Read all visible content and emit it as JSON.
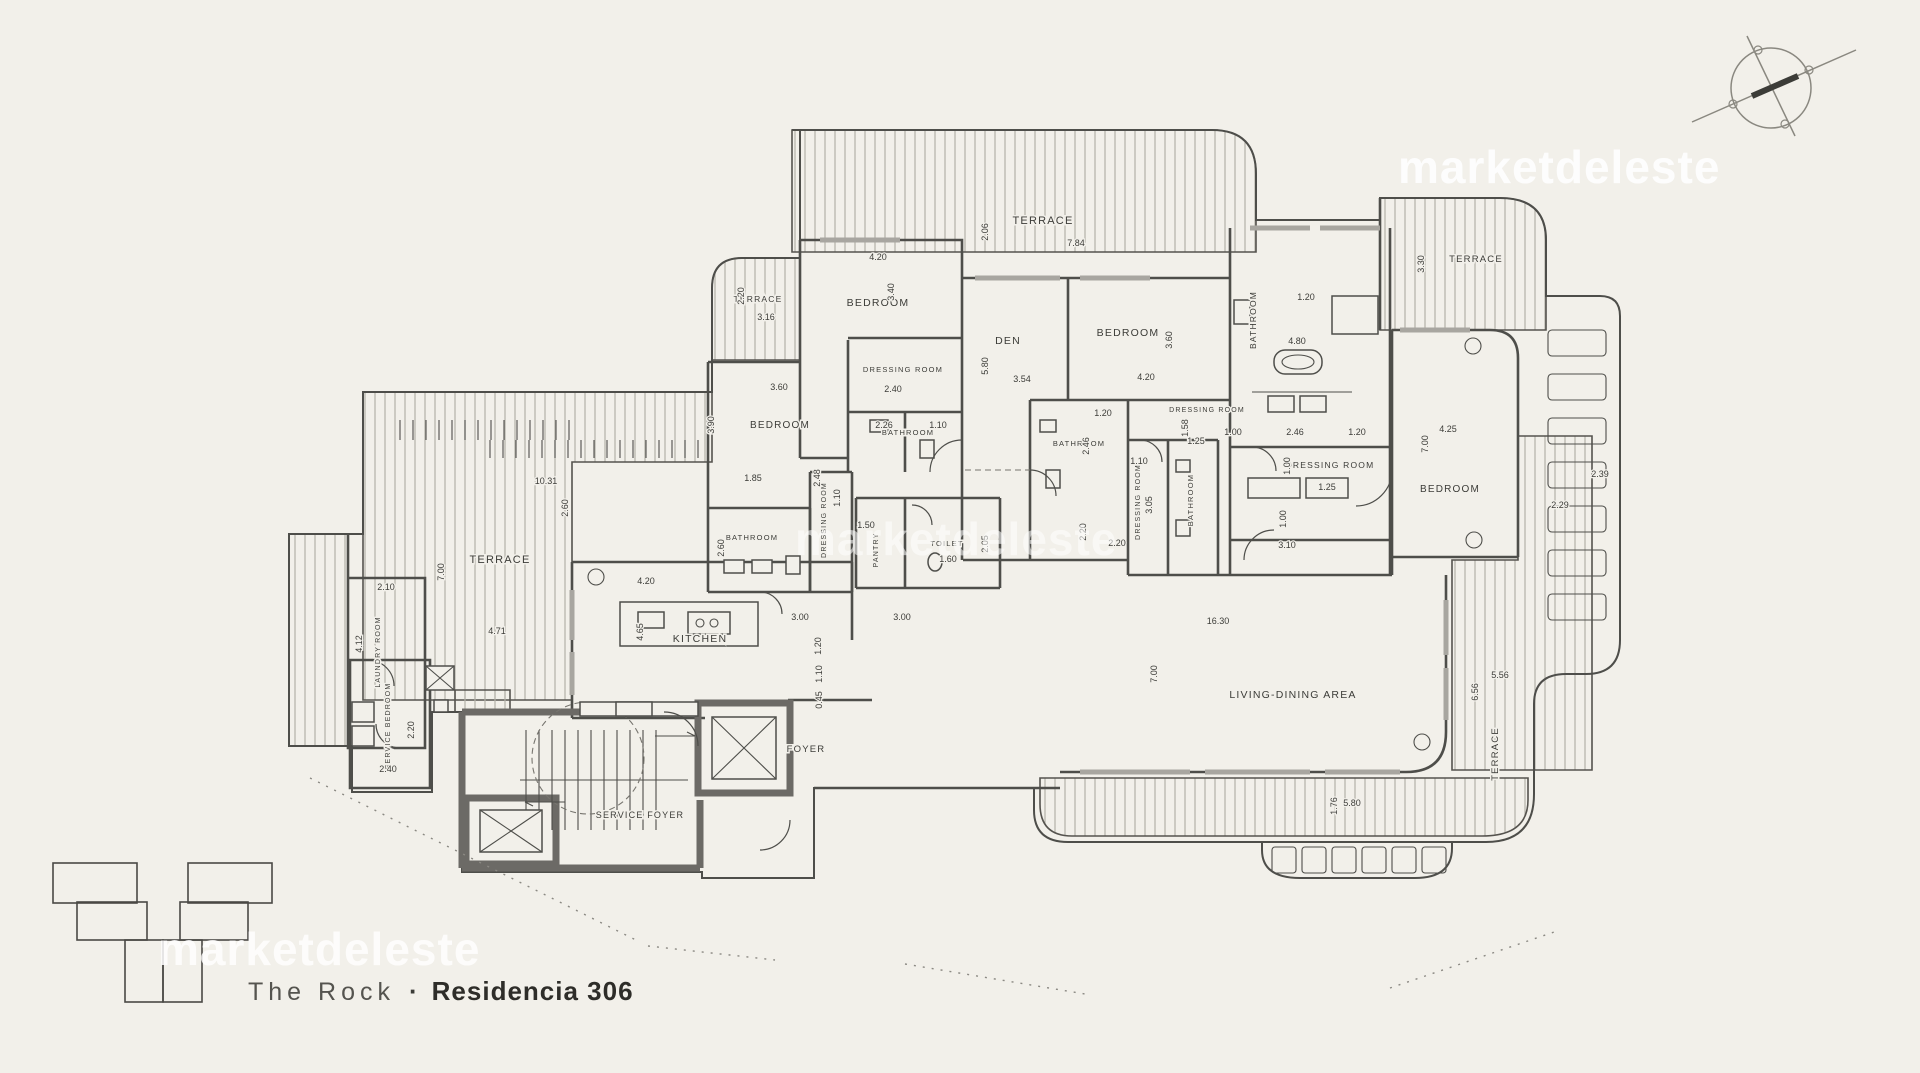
{
  "watermark": {
    "text": "marketdeleste"
  },
  "caption": {
    "project": "The Rock",
    "separator": "·",
    "unit": "Residencia 306"
  },
  "colors": {
    "background": "#f2f0ea",
    "line": "#4e4e4a",
    "wall": "#6c6a66",
    "hatch": "#b3b1a8",
    "highlight": "#8ab6bd",
    "watermark": "#ffffff",
    "text": "#3c3c38"
  },
  "keyplan": {
    "highlight_color": "#8ab6bd"
  },
  "plan": {
    "rooms": [
      {
        "label": "TERRACE",
        "x": 1043,
        "y": 224,
        "rot": 0,
        "size": 11
      },
      {
        "label": "TERRACE",
        "x": 758,
        "y": 302,
        "rot": 0,
        "size": 8.5
      },
      {
        "label": "TERRACE",
        "x": 1476,
        "y": 262,
        "rot": 0,
        "size": 9.5
      },
      {
        "label": "TERRACE",
        "x": 500,
        "y": 563,
        "rot": 0,
        "size": 11
      },
      {
        "label": "TERRACE",
        "x": 1498,
        "y": 754,
        "rot": -90,
        "size": 9.5
      },
      {
        "label": "BEDROOM",
        "x": 878,
        "y": 306,
        "rot": 0,
        "size": 10.5
      },
      {
        "label": "BEDROOM",
        "x": 780,
        "y": 428,
        "rot": 0,
        "size": 10
      },
      {
        "label": "BEDROOM",
        "x": 1128,
        "y": 336,
        "rot": 0,
        "size": 10.5
      },
      {
        "label": "BEDROOM",
        "x": 1450,
        "y": 492,
        "rot": 0,
        "size": 10
      },
      {
        "label": "DEN",
        "x": 1008,
        "y": 344,
        "rot": 0,
        "size": 10.5
      },
      {
        "label": "DRESSING ROOM",
        "x": 903,
        "y": 372,
        "rot": 0,
        "size": 7.5
      },
      {
        "label": "DRESSING ROOM",
        "x": 826,
        "y": 520,
        "rot": -90,
        "size": 7
      },
      {
        "label": "DRESSING ROOM",
        "x": 1207,
        "y": 412,
        "rot": 0,
        "size": 7
      },
      {
        "label": "DRESSING ROOM",
        "x": 1140,
        "y": 502,
        "rot": -90,
        "size": 7
      },
      {
        "label": "DRESSING ROOM",
        "x": 1330,
        "y": 468,
        "rot": 0,
        "size": 8.5
      },
      {
        "label": "BATHROOM",
        "x": 908,
        "y": 435,
        "rot": 0,
        "size": 7.5
      },
      {
        "label": "BATHROOM",
        "x": 752,
        "y": 540,
        "rot": 0,
        "size": 7.5
      },
      {
        "label": "BATHROOM",
        "x": 1079,
        "y": 446,
        "rot": 0,
        "size": 7.5
      },
      {
        "label": "BATHROOM",
        "x": 1193,
        "y": 500,
        "rot": -90,
        "size": 7.5
      },
      {
        "label": "BATHROOM",
        "x": 1256,
        "y": 320,
        "rot": -90,
        "size": 8.5
      },
      {
        "label": "TOILET",
        "x": 947,
        "y": 546,
        "rot": 0,
        "size": 7.5
      },
      {
        "label": "PANTRY",
        "x": 878,
        "y": 550,
        "rot": -90,
        "size": 7
      },
      {
        "label": "KITCHEN",
        "x": 700,
        "y": 642,
        "rot": 0,
        "size": 10.5
      },
      {
        "label": "FOYER",
        "x": 806,
        "y": 752,
        "rot": 0,
        "size": 9.5
      },
      {
        "label": "SERVICE FOYER",
        "x": 640,
        "y": 818,
        "rot": 0,
        "size": 9
      },
      {
        "label": "SERVICE BEDROOM",
        "x": 390,
        "y": 726,
        "rot": -90,
        "size": 7
      },
      {
        "label": "LAUNDRY ROOM",
        "x": 380,
        "y": 652,
        "rot": -90,
        "size": 7
      },
      {
        "label": "LIVING-DINING AREA",
        "x": 1293,
        "y": 698,
        "rot": 0,
        "size": 10.5
      }
    ],
    "dimensions": [
      {
        "v": "7.84",
        "x": 1076,
        "y": 246,
        "rot": 0
      },
      {
        "v": "2.06",
        "x": 988,
        "y": 232,
        "rot": -90
      },
      {
        "v": "4.20",
        "x": 878,
        "y": 260,
        "rot": 0
      },
      {
        "v": "3.40",
        "x": 894,
        "y": 292,
        "rot": -90
      },
      {
        "v": "2.20",
        "x": 744,
        "y": 296,
        "rot": -90
      },
      {
        "v": "3.16",
        "x": 766,
        "y": 320,
        "rot": 0
      },
      {
        "v": "3.60",
        "x": 779,
        "y": 390,
        "rot": 0
      },
      {
        "v": "3.90",
        "x": 714,
        "y": 425,
        "rot": -90
      },
      {
        "v": "2.40",
        "x": 893,
        "y": 392,
        "rot": 0
      },
      {
        "v": "5.80",
        "x": 988,
        "y": 366,
        "rot": -90
      },
      {
        "v": "3.54",
        "x": 1022,
        "y": 382,
        "rot": 0
      },
      {
        "v": "4.20",
        "x": 1146,
        "y": 380,
        "rot": 0
      },
      {
        "v": "3.60",
        "x": 1172,
        "y": 340,
        "rot": -90
      },
      {
        "v": "2.26",
        "x": 884,
        "y": 428,
        "rot": 0
      },
      {
        "v": "1.10",
        "x": 938,
        "y": 428,
        "rot": 0
      },
      {
        "v": "1.85",
        "x": 753,
        "y": 481,
        "rot": 0
      },
      {
        "v": "2.60",
        "x": 724,
        "y": 548,
        "rot": -90
      },
      {
        "v": "1.10",
        "x": 840,
        "y": 498,
        "rot": -90
      },
      {
        "v": "2.48",
        "x": 820,
        "y": 478,
        "rot": -90
      },
      {
        "v": "1.50",
        "x": 866,
        "y": 528,
        "rot": 0
      },
      {
        "v": "1.60",
        "x": 948,
        "y": 562,
        "rot": 0
      },
      {
        "v": "2.05",
        "x": 988,
        "y": 544,
        "rot": -90
      },
      {
        "v": "4.20",
        "x": 646,
        "y": 584,
        "rot": 0
      },
      {
        "v": "4.65",
        "x": 643,
        "y": 632,
        "rot": -90
      },
      {
        "v": "3.00",
        "x": 800,
        "y": 620,
        "rot": 0
      },
      {
        "v": "1.20",
        "x": 821,
        "y": 646,
        "rot": -90
      },
      {
        "v": "1.10",
        "x": 822,
        "y": 674,
        "rot": -90
      },
      {
        "v": "0.45",
        "x": 822,
        "y": 700,
        "rot": -90
      },
      {
        "v": "3.00",
        "x": 902,
        "y": 620,
        "rot": 0
      },
      {
        "v": "16.30",
        "x": 1218,
        "y": 624,
        "rot": 0
      },
      {
        "v": "7.00",
        "x": 1157,
        "y": 674,
        "rot": -90
      },
      {
        "v": "5.80",
        "x": 1352,
        "y": 806,
        "rot": 0
      },
      {
        "v": "1.76",
        "x": 1337,
        "y": 806,
        "rot": -90
      },
      {
        "v": "10.31",
        "x": 546,
        "y": 484,
        "rot": 0
      },
      {
        "v": "2.60",
        "x": 568,
        "y": 508,
        "rot": -90
      },
      {
        "v": "7.00",
        "x": 444,
        "y": 572,
        "rot": -90
      },
      {
        "v": "4.71",
        "x": 497,
        "y": 634,
        "rot": 0
      },
      {
        "v": "2.10",
        "x": 386,
        "y": 590,
        "rot": 0
      },
      {
        "v": "4.12",
        "x": 362,
        "y": 644,
        "rot": -90
      },
      {
        "v": "2.20",
        "x": 414,
        "y": 730,
        "rot": -90
      },
      {
        "v": "2.40",
        "x": 388,
        "y": 772,
        "rot": 0
      },
      {
        "v": "1.20",
        "x": 1103,
        "y": 416,
        "rot": 0
      },
      {
        "v": "2.46",
        "x": 1089,
        "y": 446,
        "rot": -90
      },
      {
        "v": "1.10",
        "x": 1139,
        "y": 464,
        "rot": 0
      },
      {
        "v": "2.20",
        "x": 1086,
        "y": 532,
        "rot": -90
      },
      {
        "v": "2.20",
        "x": 1117,
        "y": 546,
        "rot": 0
      },
      {
        "v": "3.05",
        "x": 1152,
        "y": 505,
        "rot": -90
      },
      {
        "v": "1.58",
        "x": 1188,
        "y": 428,
        "rot": -90
      },
      {
        "v": "1.25",
        "x": 1196,
        "y": 444,
        "rot": 0
      },
      {
        "v": "4.80",
        "x": 1297,
        "y": 344,
        "rot": 0
      },
      {
        "v": "1.20",
        "x": 1306,
        "y": 300,
        "rot": 0
      },
      {
        "v": "1.00",
        "x": 1233,
        "y": 435,
        "rot": 0
      },
      {
        "v": "2.46",
        "x": 1295,
        "y": 435,
        "rot": 0
      },
      {
        "v": "1.20",
        "x": 1357,
        "y": 435,
        "rot": 0
      },
      {
        "v": "1.00",
        "x": 1290,
        "y": 466,
        "rot": -90
      },
      {
        "v": "1.25",
        "x": 1327,
        "y": 490,
        "rot": 0
      },
      {
        "v": "1.00",
        "x": 1286,
        "y": 519,
        "rot": -90
      },
      {
        "v": "3.10",
        "x": 1287,
        "y": 548,
        "rot": 0
      },
      {
        "v": "4.25",
        "x": 1448,
        "y": 432,
        "rot": 0
      },
      {
        "v": "7.00",
        "x": 1428,
        "y": 444,
        "rot": -90
      },
      {
        "v": "3.30",
        "x": 1424,
        "y": 264,
        "rot": -90
      },
      {
        "v": "2.29",
        "x": 1560,
        "y": 508,
        "rot": 0
      },
      {
        "v": "2.39",
        "x": 1600,
        "y": 477,
        "rot": 0
      },
      {
        "v": "5.56",
        "x": 1500,
        "y": 678,
        "rot": 0
      },
      {
        "v": "6.56",
        "x": 1478,
        "y": 692,
        "rot": -90
      }
    ]
  }
}
